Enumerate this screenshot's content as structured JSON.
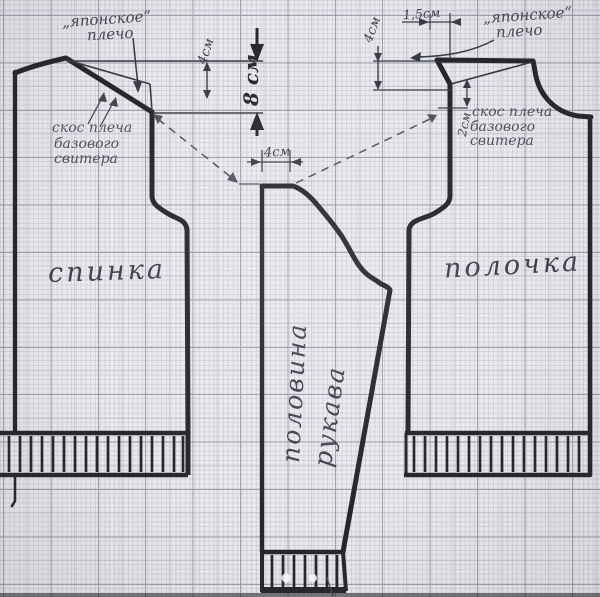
{
  "diagram_title": "Выкройка свитера с японским плечом (спинка, полочка, половина рукава)",
  "labels": {
    "left_shoulder_type": {
      "line1": "„японское“",
      "line2": "плечо"
    },
    "right_shoulder_type": {
      "line1": "„японское“",
      "line2": "плечо"
    },
    "left_base_slope": {
      "line1": "скос плеча",
      "line2": "базового",
      "line3": "свитера"
    },
    "right_base_slope": {
      "line1": "скос плеча",
      "line2": "базового",
      "line3": "свитера"
    },
    "back_piece": "спинка",
    "front_piece": "полочка",
    "sleeve_piece": {
      "line1": "половина",
      "line2": "рукава"
    }
  },
  "measurements": {
    "left_shoulder_drop": "4см",
    "center_depth": "8 см",
    "sleeve_top_width": "4см",
    "right_top_offset": "1,5см",
    "right_shoulder_drop": "4см",
    "right_slope_gap": "2см"
  },
  "colors": {
    "paper": "#eae9ee",
    "grid_major": "#9496a4",
    "ink": "#26262b",
    "pencil": "#50535e"
  }
}
